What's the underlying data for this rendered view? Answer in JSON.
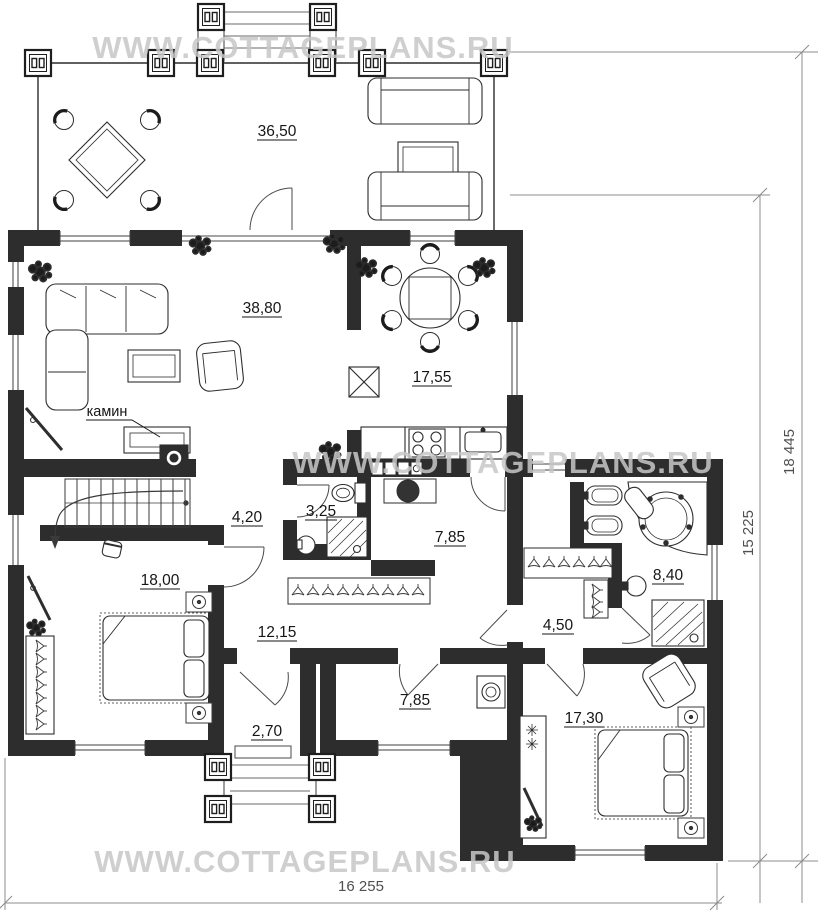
{
  "watermark": {
    "text": "WWW.COTTAGEPLANS.RU",
    "color": "#c7c7c7"
  },
  "rooms": [
    {
      "id": "terrace",
      "area": "36,50"
    },
    {
      "id": "living-room",
      "area": "38,80"
    },
    {
      "id": "kitchen-dining",
      "area": "17,55"
    },
    {
      "id": "stair-hall",
      "area": "4,20"
    },
    {
      "id": "bathroom-small",
      "area": "3,25"
    },
    {
      "id": "corridor-upper",
      "area": "7,85"
    },
    {
      "id": "bedroom-1",
      "area": "18,00"
    },
    {
      "id": "hallway-central",
      "area": "12,15"
    },
    {
      "id": "entry-vestibule",
      "area": "2,70"
    },
    {
      "id": "utility-room",
      "area": "7,85"
    },
    {
      "id": "wardrobe-corridor",
      "area": "4,50"
    },
    {
      "id": "bathroom-big",
      "area": "8,40"
    },
    {
      "id": "bedroom-2",
      "area": "17,30"
    }
  ],
  "labels": {
    "fireplace": "камин"
  },
  "dimensions": {
    "width_bottom": "16 255",
    "height_right_outer": "18 445",
    "height_right_inner": "15 225"
  },
  "colors": {
    "wall": "#2d2d2d",
    "line": "#3a3a3a",
    "dim": "#8c8c8c",
    "watermark": "#c7c7c7"
  }
}
